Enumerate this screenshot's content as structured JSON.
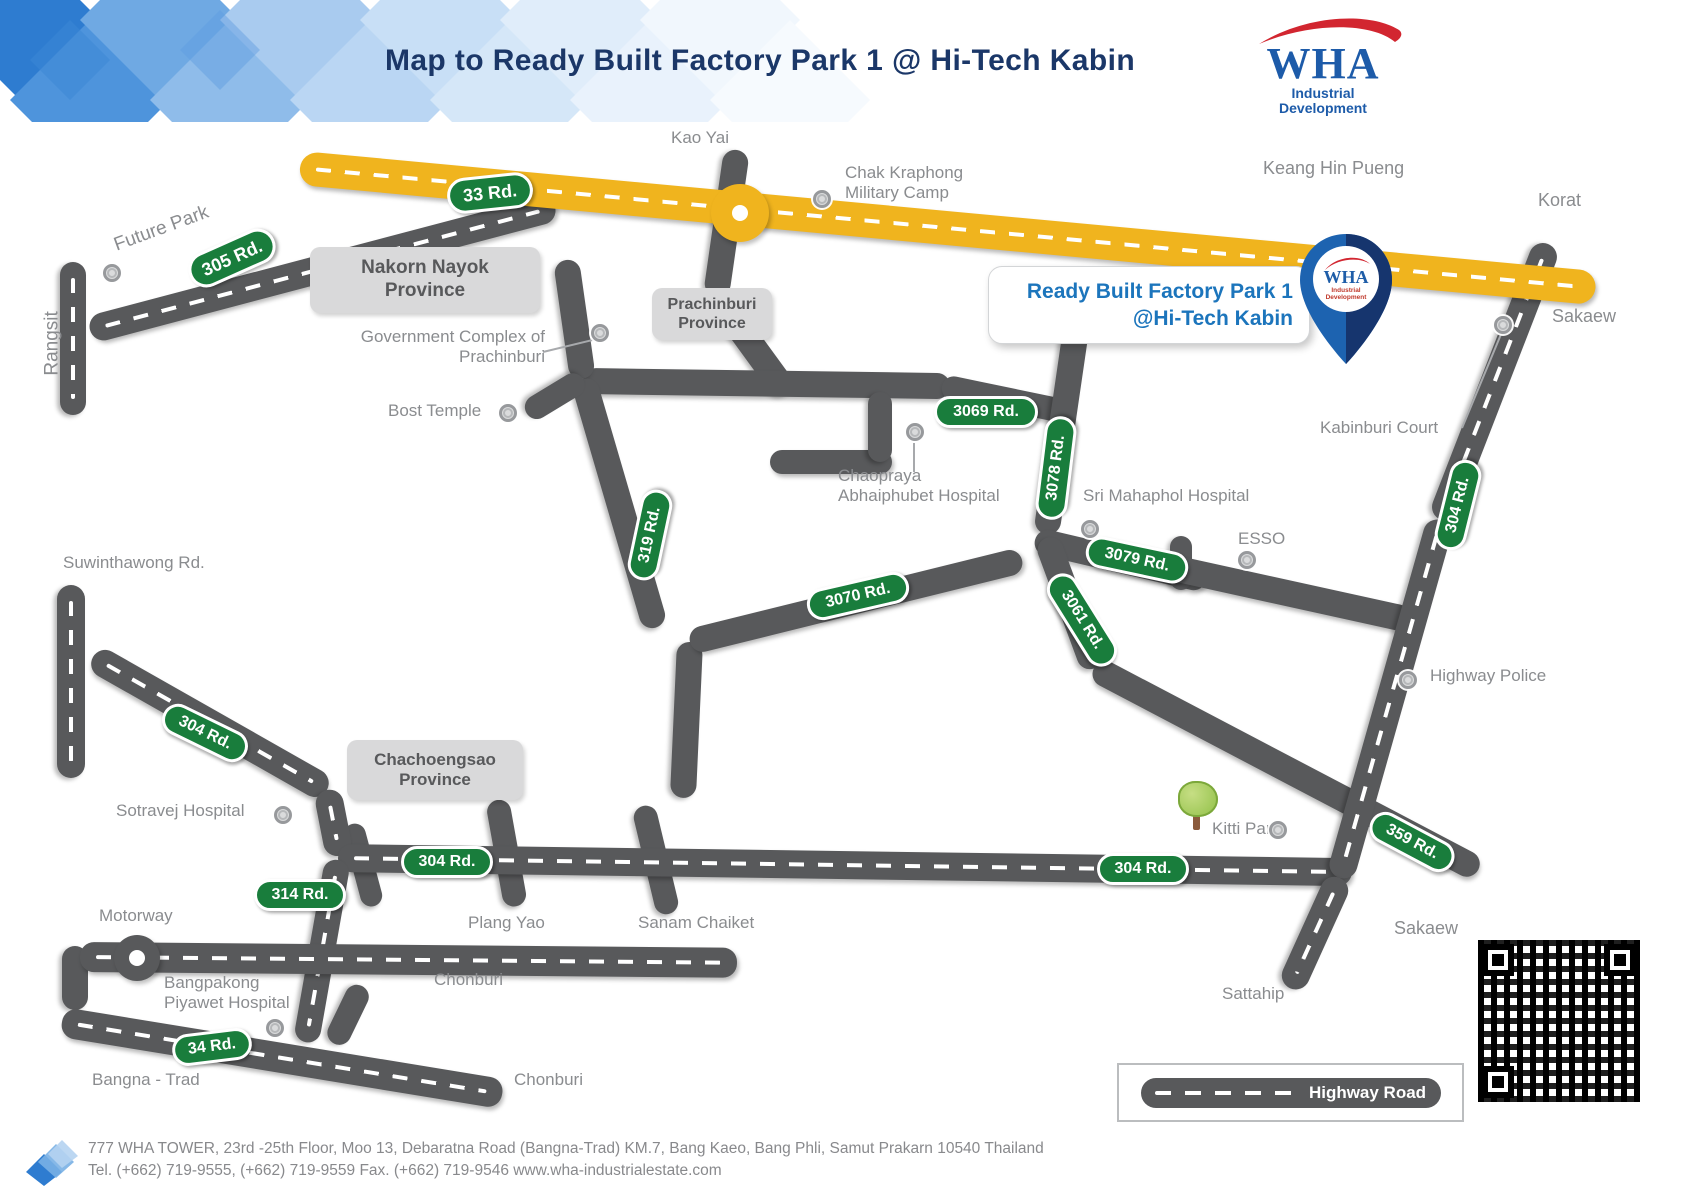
{
  "header": {
    "title": "Map to Ready Built Factory Park 1 @ Hi-Tech Kabin",
    "logo": {
      "brand": "WHA",
      "tagline_line1": "Industrial",
      "tagline_line2": "Development"
    }
  },
  "callout": {
    "line1": "Ready Built Factory Park 1",
    "line2": "@Hi-Tech Kabin"
  },
  "pin": {
    "brand": "WHA"
  },
  "legend": {
    "label": "Highway Road"
  },
  "map": {
    "province_boxes": {
      "nakorn_nayok": "Nakorn Nayok\nProvince",
      "prachinburi": "Prachinburi\nProvince",
      "chachoengsao": "Chachoengsao\nProvince"
    },
    "labels": {
      "kao_yai": "Kao Yai",
      "chak_kraphong": "Chak Kraphong\nMilitary Camp",
      "keang_hin_pueng": "Keang Hin Pueng",
      "korat": "Korat",
      "sakaew_top": "Sakaew",
      "future_park": "Future Park",
      "rangsit": "Rangsit",
      "government_complex": "Government Complex of\nPrachinburi",
      "bost_temple": "Bost Temple",
      "chaopraya": "Chaopraya\nAbhaiphubet Hospital",
      "sri_mahaphol": "Sri Mahaphol Hospital",
      "esso": "ESSO",
      "kabinburi_court": "Kabinburi Court",
      "suwinthawong": "Suwinthawong Rd.",
      "highway_police": "Highway Police",
      "sotravej": "Sotravej Hospital",
      "kitti_park": "Kitti Park",
      "plang_yao": "Plang Yao",
      "sanam_chaiket": "Sanam Chaiket",
      "motorway": "Motorway",
      "bangpakong": "Bangpakong\nPiyawet Hospital",
      "chonburi_upper": "Chonburi",
      "chonburi_lower": "Chonburi",
      "bangna_trad": "Bangna - Trad",
      "sattahip": "Sattahip",
      "sakaew_bottom": "Sakaew"
    },
    "badges": {
      "b33": "33 Rd.",
      "b305": "305 Rd.",
      "b3069": "3069 Rd.",
      "b3078": "3078 Rd.",
      "b3079": "3079 Rd.",
      "b3061": "3061 Rd.",
      "b3070": "3070 Rd.",
      "b319": "319 Rd.",
      "b304_left": "304 Rd.",
      "b304_mid": "304 Rd.",
      "b304_right": "304 Rd.",
      "b304_vert": "304 Rd.",
      "b359": "359 Rd.",
      "b314": "314 Rd.",
      "b34": "34 Rd."
    },
    "colors": {
      "road_gray": "#58595B",
      "highway_yellow": "#F0B41E",
      "badge_green": "#197D3C",
      "title_navy": "#1B3768",
      "callout_blue": "#1C75BC",
      "label_gray": "#8A8C8F"
    }
  },
  "footer": {
    "line1": "777 WHA TOWER, 23rd -25th Floor, Moo 13, Debaratna Road (Bangna-Trad) KM.7, Bang Kaeo, Bang Phli, Samut Prakarn 10540 Thailand",
    "line2": "Tel. (+662) 719-9555, (+662) 719-9559 Fax. (+662) 719-9546  www.wha-industrialestate.com"
  }
}
